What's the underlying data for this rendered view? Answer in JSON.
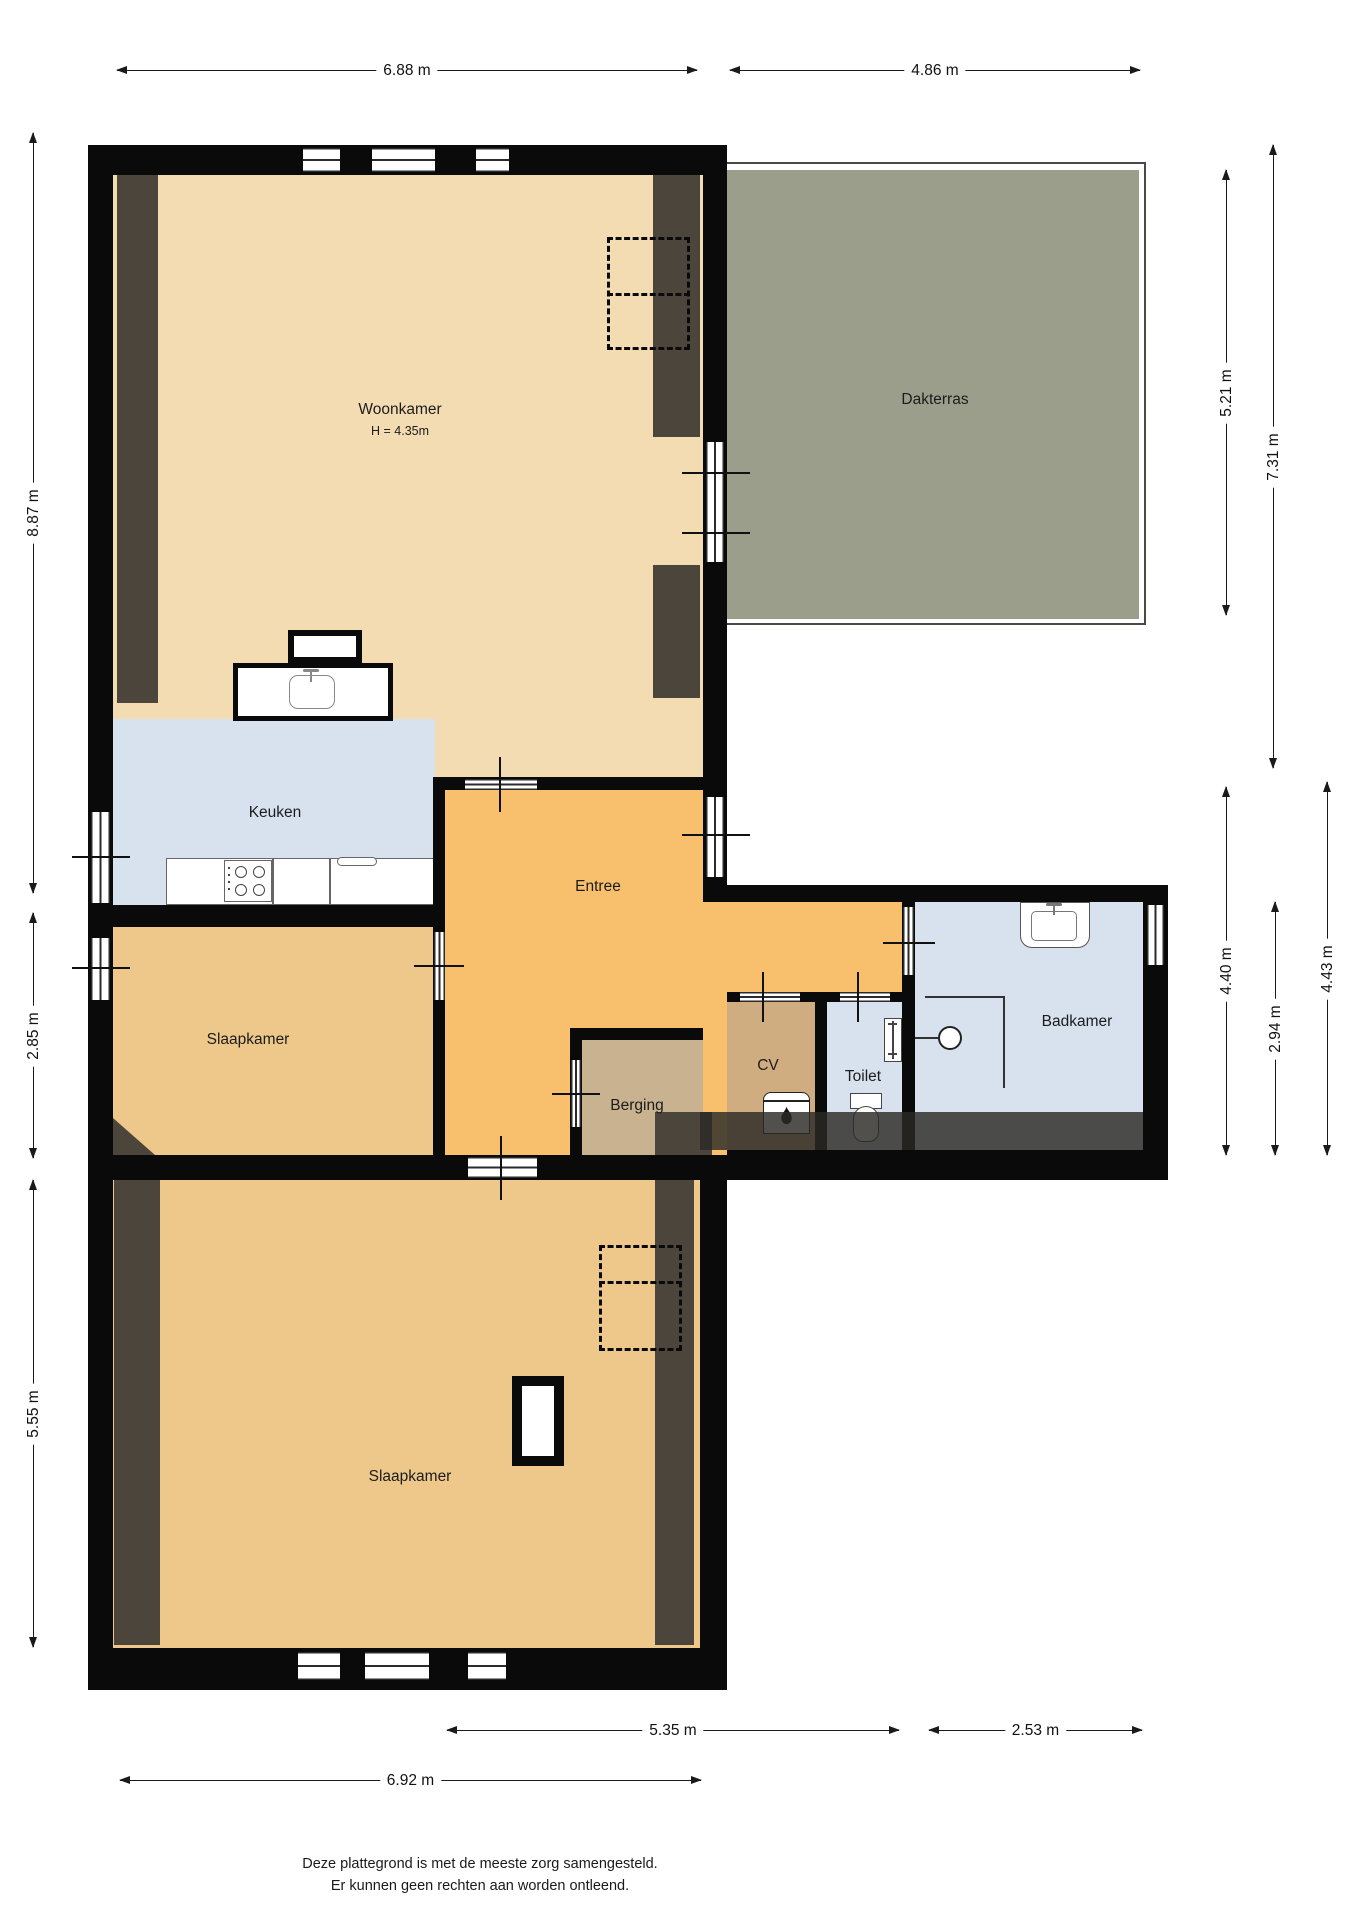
{
  "title": "Plattegrond verdieping",
  "rooms": {
    "woonkamer": {
      "label": "Woonkamer",
      "height_note": "H = 4.35m"
    },
    "dakterras": {
      "label": "Dakterras"
    },
    "keuken": {
      "label": "Keuken"
    },
    "entree": {
      "label": "Entree"
    },
    "slaapkamer_links": {
      "label": "Slaapkamer"
    },
    "slaapkamer_onder": {
      "label": "Slaapkamer"
    },
    "badkamer": {
      "label": "Badkamer"
    },
    "toilet": {
      "label": "Toilet"
    },
    "cv": {
      "label": "CV"
    },
    "berging": {
      "label": "Berging"
    }
  },
  "dimensions": {
    "top": [
      {
        "label": "6.88 m"
      },
      {
        "label": "4.86 m"
      }
    ],
    "left": [
      {
        "label": "8.87 m"
      },
      {
        "label": "2.85 m"
      },
      {
        "label": "5.55 m"
      }
    ],
    "right": [
      {
        "label": "5.21 m"
      },
      {
        "label": "7.31 m"
      },
      {
        "label": "4.40 m"
      },
      {
        "label": "2.94 m"
      },
      {
        "label": "4.43 m"
      }
    ],
    "bottom": [
      {
        "label": "5.35 m"
      },
      {
        "label": "2.53 m"
      },
      {
        "label": "6.92 m"
      }
    ]
  },
  "footer": {
    "line1": "Deze plattegrond is met de meeste zorg samengesteld.",
    "line2": "Er kunnen geen rechten aan worden ontleend."
  },
  "colors": {
    "wall": "#0a0a0a",
    "woonkamer_floor": "#f3dcb2",
    "keuken_badkamer_floor": "#d7e2ee",
    "entree_floor": "#f8bf6d",
    "slaapkamer_floor": "#eec88b",
    "berging_floor": "#c9b290",
    "cv_floor": "#d0ad80",
    "dakterras": "#9c9e8c",
    "sloped_ceiling_strip": "#4c453b"
  }
}
